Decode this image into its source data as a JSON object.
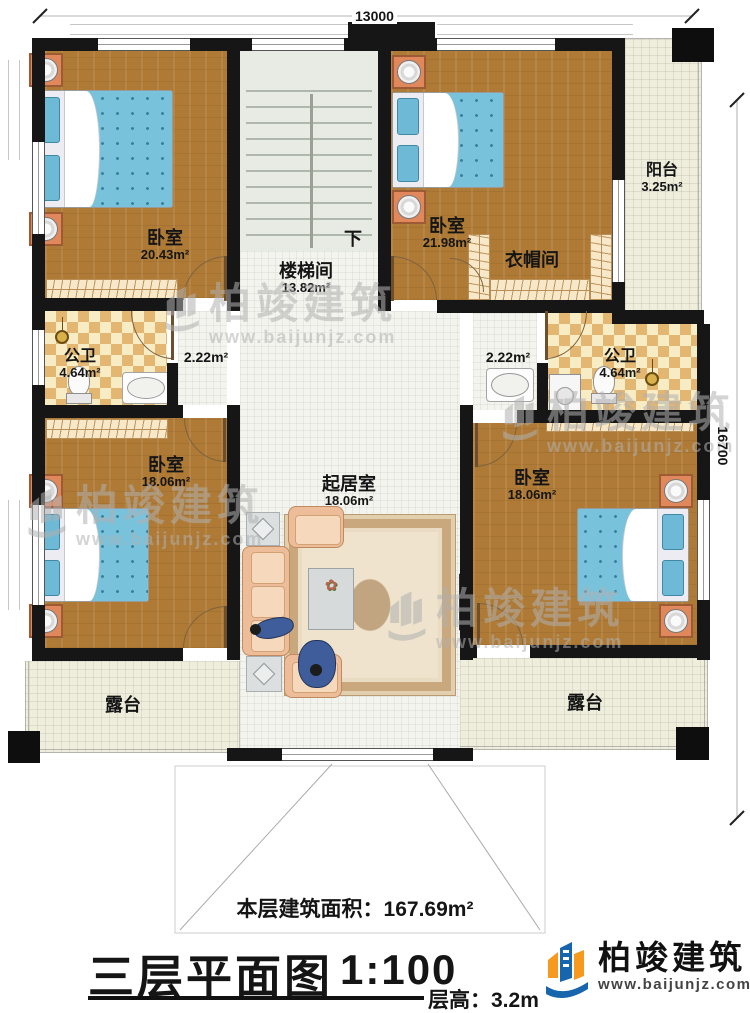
{
  "dimensions": {
    "top": "13000",
    "right": "16700"
  },
  "rooms": {
    "bedroom_tl": {
      "label": "卧室",
      "area": "20.43m²"
    },
    "stairwell": {
      "label": "楼梯间",
      "area": "13.82m²",
      "direction": "下"
    },
    "bedroom_tr": {
      "label": "卧室",
      "area": "21.98m²"
    },
    "cloakroom": {
      "label": "衣帽间"
    },
    "balcony": {
      "label": "阳台",
      "area": "3.25m²"
    },
    "bathroom_left": {
      "label": "公卫",
      "area": "4.64m²"
    },
    "hall_left": {
      "area": "2.22m²"
    },
    "hall_right": {
      "area": "2.22m²"
    },
    "bathroom_right": {
      "label": "公卫",
      "area": "4.64m²"
    },
    "bedroom_bl": {
      "label": "卧室",
      "area": "18.06m²"
    },
    "living": {
      "label": "起居室",
      "area": "18.06m²"
    },
    "bedroom_br": {
      "label": "卧室",
      "area": "18.06m²"
    },
    "terrace_left": {
      "label": "露台"
    },
    "terrace_right": {
      "label": "露台"
    }
  },
  "footer": {
    "area_note": "本层建筑面积：167.69m²",
    "title": "三层平面图",
    "scale": "1:100",
    "floor_height": "层高：3.2m"
  },
  "brand": {
    "name": "柏竣建筑",
    "url": "www.baijunjz.com"
  },
  "watermark": {
    "name": "柏竣建筑",
    "url": "www.baijunjz.com"
  },
  "colors": {
    "wall": "#161616",
    "wood": "#ae7a35",
    "bed_blue": "#79c2dc",
    "accent_orange": "#f59a1f",
    "accent_blue": "#1766ad"
  }
}
